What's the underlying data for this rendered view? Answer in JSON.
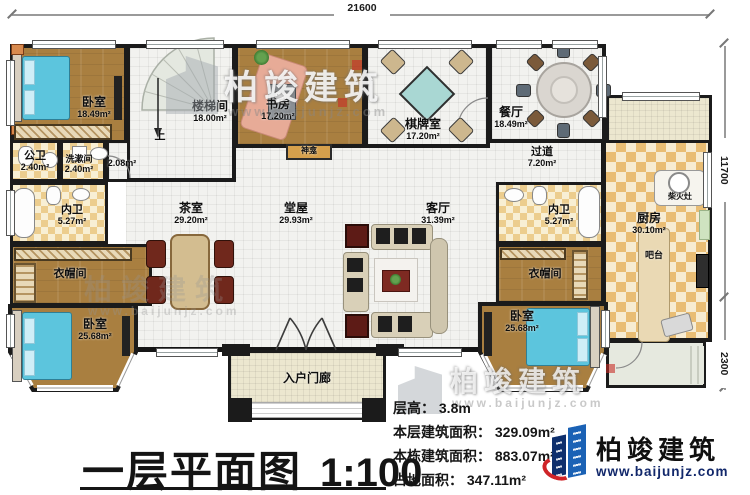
{
  "meta": {
    "drawing_type": "floor-plan"
  },
  "dimensions": {
    "top": "21600",
    "right_upper": "11700",
    "right_lower": "2300"
  },
  "rooms": {
    "bedroom_tl": {
      "name": "卧室",
      "area": "18.49m²"
    },
    "stair_hall": {
      "name": "楼梯间",
      "area": "18.00m²",
      "up": "上"
    },
    "study": {
      "name": "书房",
      "area": "17.20m²"
    },
    "chess_room": {
      "name": "棋牌室",
      "area": "17.20m²"
    },
    "dining": {
      "name": "餐厅",
      "area": "18.49m²"
    },
    "public_wc": {
      "name": "公卫",
      "area": "2.40m²"
    },
    "washroom": {
      "name": "洗漱间",
      "area": "2.40m²"
    },
    "niche": {
      "area": "2.08m²"
    },
    "inner_wc_left": {
      "name": "内卫",
      "area": "5.27m²"
    },
    "corridor": {
      "name": "过道",
      "area": "7.20m²"
    },
    "tea_room": {
      "name": "茶室",
      "area": "29.20m²"
    },
    "main_hall": {
      "name": "堂屋",
      "area": "29.93m²"
    },
    "living_room": {
      "name": "客厅",
      "area": "31.39m²"
    },
    "inner_wc_right": {
      "name": "内卫",
      "area": "5.27m²"
    },
    "kitchen": {
      "name": "厨房",
      "area": "30.10m²"
    },
    "cloak_left": {
      "name": "衣帽间"
    },
    "cloak_right": {
      "name": "衣帽间"
    },
    "bedroom_bl": {
      "name": "卧室",
      "area": "25.68m²"
    },
    "bedroom_br": {
      "name": "卧室",
      "area": "25.68m²"
    },
    "shrine": {
      "name": "神龛"
    },
    "firewood_stove": {
      "name": "柴火灶"
    },
    "bar_counter": {
      "name": "吧台"
    },
    "entry_porch": {
      "name": "入户门廊"
    }
  },
  "title": {
    "text": "一层平面图",
    "scale": "1:100"
  },
  "stats": {
    "lines": [
      "层高： 3.8m",
      "本层建筑面积： 329.09m²",
      "本栋建筑面积： 883.07m²",
      "占地面积： 347.11m²"
    ]
  },
  "logo": {
    "company": "柏竣建筑",
    "website": "www.baijunjz.com"
  },
  "watermark": {
    "company": "柏竣建筑",
    "website": "www.baijunjz.com"
  },
  "colors": {
    "wall": "#1b1b1b",
    "wood_floor": "#a97f40",
    "tile_floor": "#f2f2ef",
    "bath_tile": "#eccd8e",
    "kitchen_tile": "#e9bd74",
    "bed": "#5cc5dd",
    "logo_blue": "#1b62b5",
    "logo_navy": "#0e2f6d",
    "logo_red": "#cf2428"
  }
}
